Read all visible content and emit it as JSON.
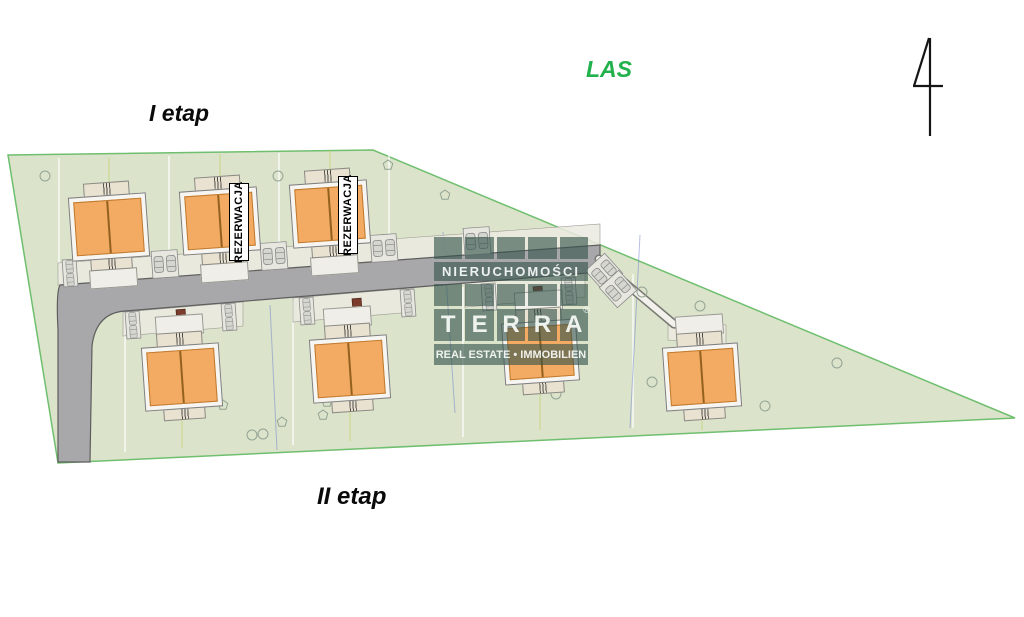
{
  "labels": {
    "forest": "LAS",
    "stage_1": "I etap",
    "stage_2": "II etap",
    "reservation": "REZERWACJA"
  },
  "watermark": {
    "top_line": "NIERUCHOMOŚCI",
    "brand_letters": [
      "T",
      "E",
      "R",
      "R",
      "A"
    ],
    "registered_mark": "®",
    "bottom_line": "REAL ESTATE • IMMOBILIEN"
  },
  "site": {
    "stage_1_house_count": 3,
    "stage_2_house_count": 4,
    "reserved_house_count": 2
  },
  "colors": {
    "forest_label": "#22b14c",
    "stage_label": "#0a0a0a",
    "plot_fill": "#dbe3cb",
    "plot_border": "#6fbf6f",
    "house_fill": "#f3aa62",
    "house_border": "#bf7a2e",
    "house_frame": "#f6f5f1",
    "annex_fill": "#eae2d0",
    "road_fill": "#a8a8aa",
    "door_marker": "#7b3c2c",
    "watermark_block": "#33524a"
  }
}
